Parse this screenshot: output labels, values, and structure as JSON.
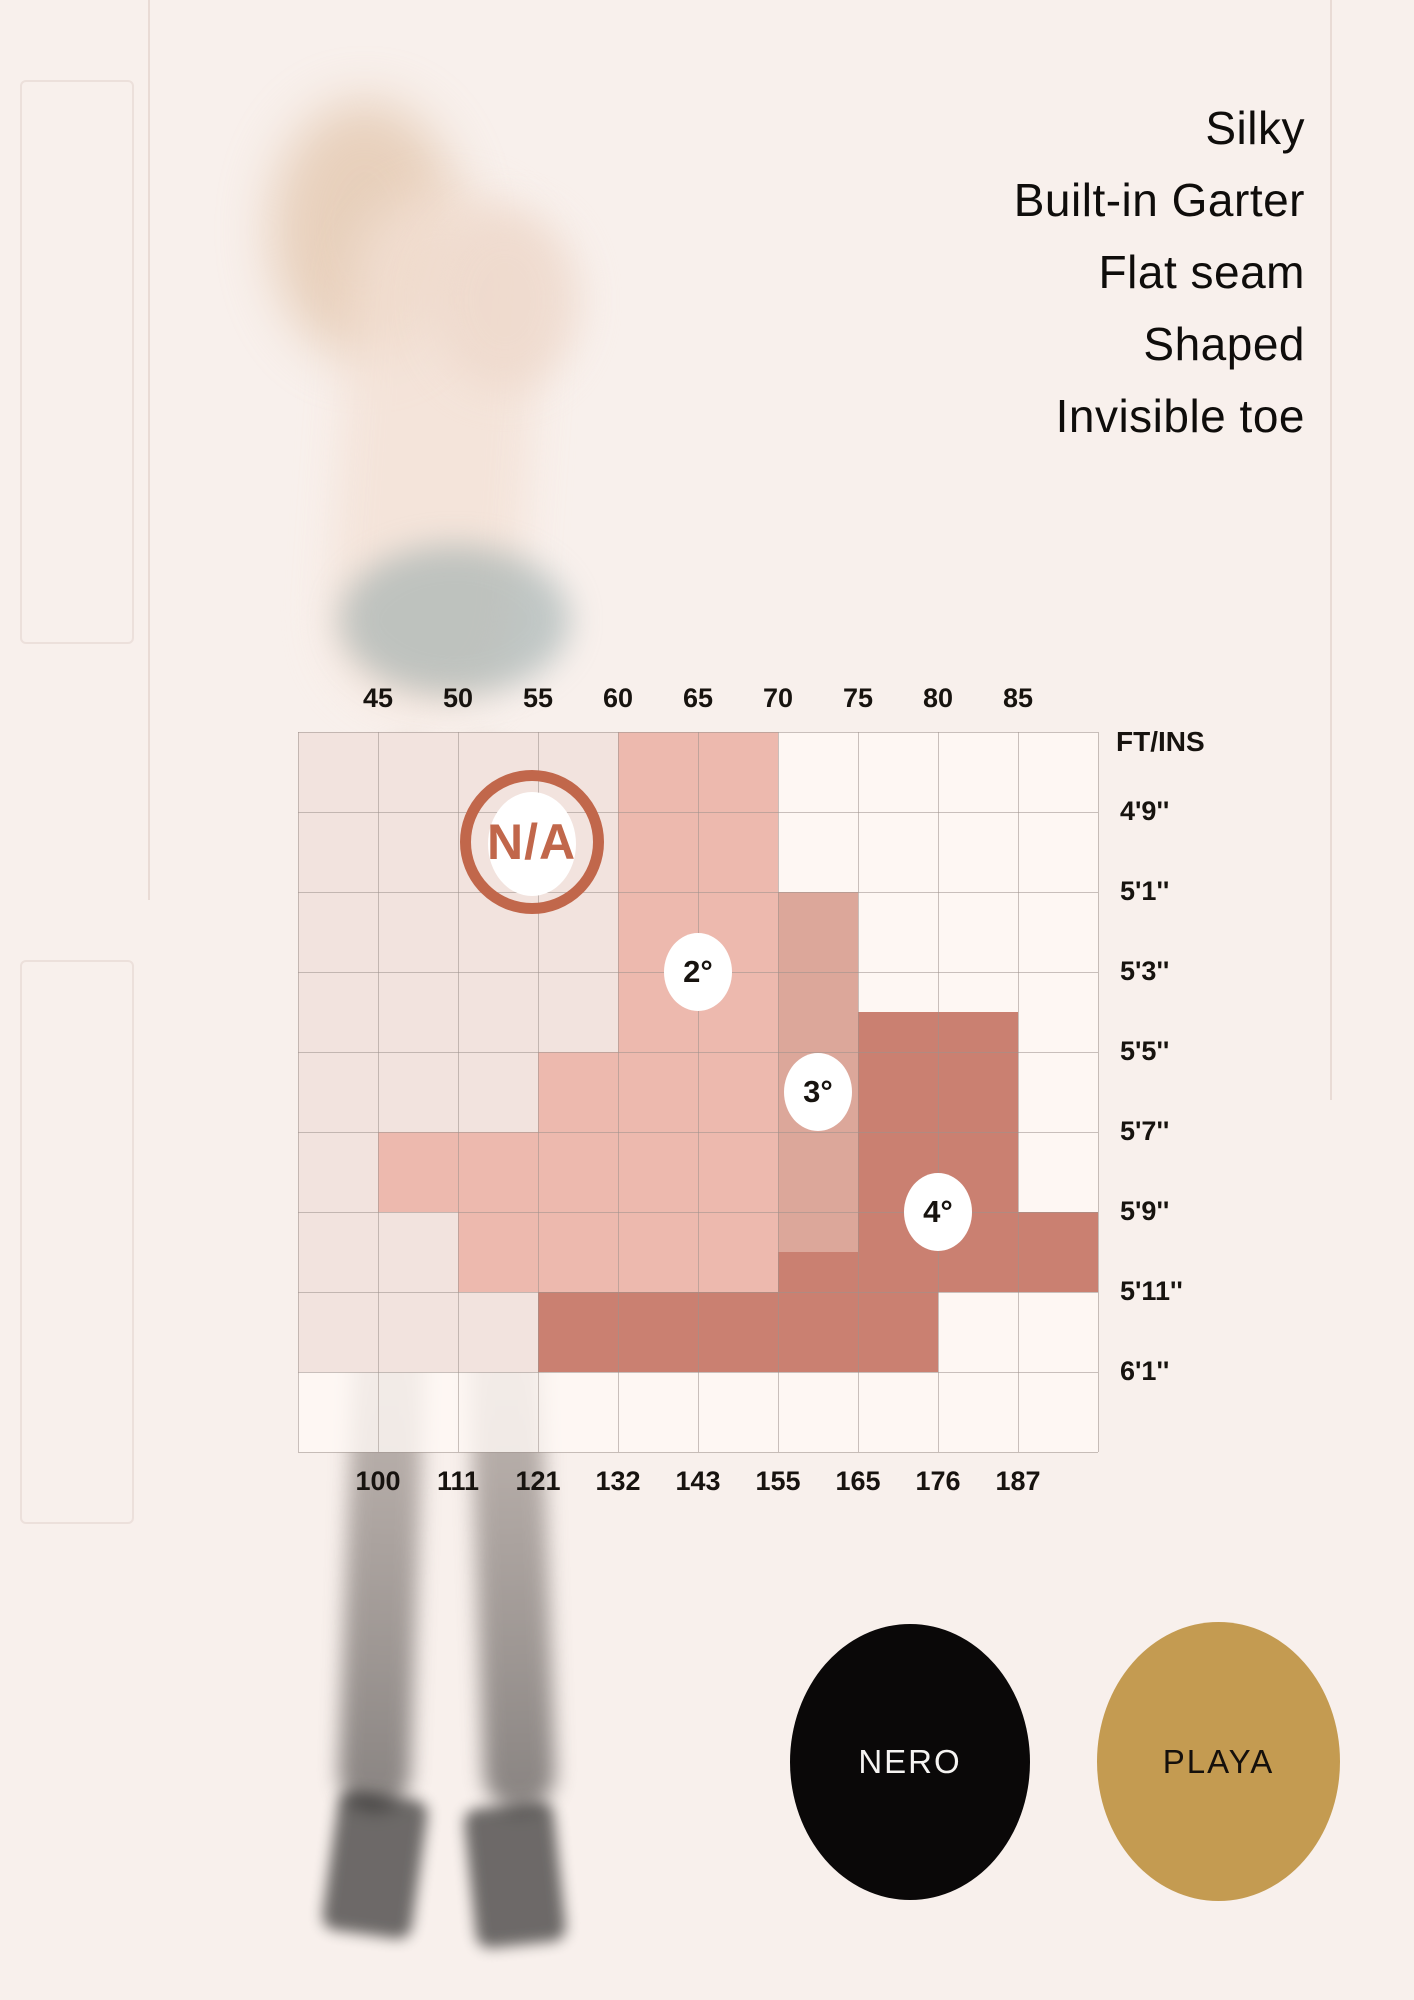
{
  "features": {
    "items": [
      "Silky",
      "Built-in Garter",
      "Flat seam",
      "Shaped",
      "Invisible toe"
    ]
  },
  "chart_data": {
    "type": "heatmap",
    "title": "Hosiery size chart (height vs weight)",
    "grid": {
      "cols": 10,
      "rows": 9
    },
    "axes": {
      "top": {
        "title": "KG",
        "ticks": [
          "45",
          "50",
          "55",
          "60",
          "65",
          "70",
          "75",
          "80",
          "85"
        ]
      },
      "bottom": {
        "title": "LBS",
        "ticks": [
          "100",
          "111",
          "121",
          "132",
          "143",
          "155",
          "165",
          "176",
          "187"
        ]
      },
      "left": {
        "title": "CM",
        "ticks": [
          "145",
          "150",
          "155",
          "160",
          "165",
          "170",
          "175",
          "180"
        ]
      },
      "right": {
        "title": "FT/INS",
        "ticks": [
          "4'9''",
          "5'1''",
          "5'3''",
          "5'5''",
          "5'7''",
          "5'9''",
          "5'11''",
          "6'1''"
        ]
      }
    },
    "base_fill": "rgba(255,249,245,0.8)",
    "line_color": "rgba(156,146,140,0.55)",
    "na_color": "#c1674b",
    "sizes": [
      {
        "label": "N/A",
        "color": "#f2e3de",
        "rects": [
          [
            0,
            0,
            4,
            4
          ],
          [
            0,
            4,
            3,
            5
          ],
          [
            0,
            5,
            1,
            6
          ],
          [
            0,
            6,
            2,
            7
          ],
          [
            0,
            7,
            3,
            8
          ]
        ],
        "badge_pos": [
          2.92,
          1.38
        ]
      },
      {
        "label": "2°",
        "color": "#edb9ae",
        "rects": [
          [
            4,
            0,
            6,
            4
          ],
          [
            3,
            4,
            6,
            5
          ],
          [
            1,
            5,
            6,
            6
          ],
          [
            2,
            6,
            6,
            7
          ]
        ],
        "badge_pos": [
          5,
          3
        ]
      },
      {
        "label": "3°",
        "color": "#dca79a",
        "rects": [
          [
            6,
            2,
            7,
            6
          ],
          [
            6,
            6,
            7,
            6.5
          ]
        ],
        "badge_pos": [
          6.5,
          4.5
        ]
      },
      {
        "label": "4°",
        "color": "#ca8071",
        "rects": [
          [
            7,
            3.5,
            9,
            4
          ],
          [
            7,
            4,
            9,
            6
          ],
          [
            6,
            6.5,
            7,
            7
          ],
          [
            7,
            6,
            10,
            7
          ],
          [
            3,
            7,
            8,
            8
          ]
        ],
        "badge_pos": [
          8,
          6
        ]
      }
    ]
  },
  "swatches": [
    {
      "name": "NERO",
      "fill": "#0a0808",
      "text_color": "#f6f4f2"
    },
    {
      "name": "PLAYA",
      "fill": "#c49b51",
      "text_color": "#15100c"
    }
  ]
}
